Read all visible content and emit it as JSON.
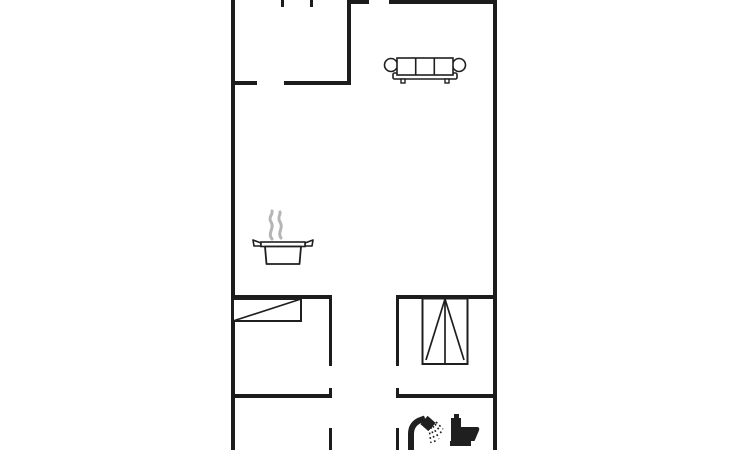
{
  "app": {
    "title": "floor-plan"
  },
  "canvas": {
    "width": 730,
    "height": 450,
    "background": "#ffffff"
  },
  "colors": {
    "wall": "#1c1c1c",
    "fixture": "#1f1f1f",
    "furniture_fill": "#ffffff",
    "steam": "#b5b5b5",
    "background": "#ffffff"
  },
  "walls": [
    {
      "name": "outer-wall-west",
      "x": 231,
      "y": 0,
      "w": 4,
      "h": 450
    },
    {
      "name": "outer-wall-east",
      "x": 493,
      "y": 0,
      "w": 4,
      "h": 450
    },
    {
      "name": "living-room-north-wall-west-segment",
      "x": 347,
      "y": 0,
      "w": 22,
      "h": 4
    },
    {
      "name": "living-room-north-wall-east-segment",
      "x": 389,
      "y": 0,
      "w": 108,
      "h": 4
    },
    {
      "name": "entrance-door-jamb-west",
      "x": 281,
      "y": 0,
      "w": 3,
      "h": 7
    },
    {
      "name": "entrance-door-jamb-east",
      "x": 310,
      "y": 0,
      "w": 3,
      "h": 7
    },
    {
      "name": "hall-living-divider-wall",
      "x": 347,
      "y": 0,
      "w": 4,
      "h": 85
    },
    {
      "name": "hall-south-wall-west-segment",
      "x": 231,
      "y": 81,
      "w": 26,
      "h": 4
    },
    {
      "name": "hall-south-wall-east-segment",
      "x": 284,
      "y": 81,
      "w": 67,
      "h": 4
    },
    {
      "name": "bedroom-north-wall-west",
      "x": 231,
      "y": 295,
      "w": 101,
      "h": 4
    },
    {
      "name": "bedroom-north-wall-east",
      "x": 396,
      "y": 295,
      "w": 101,
      "h": 4
    },
    {
      "name": "corridor-west-wall-upper",
      "x": 329,
      "y": 295,
      "w": 3,
      "h": 71
    },
    {
      "name": "corridor-east-wall-upper",
      "x": 396,
      "y": 295,
      "w": 3,
      "h": 71
    },
    {
      "name": "corridor-west-door-jamb",
      "x": 329,
      "y": 388,
      "w": 3,
      "h": 9
    },
    {
      "name": "corridor-east-door-jamb",
      "x": 396,
      "y": 388,
      "w": 3,
      "h": 9
    },
    {
      "name": "bedroom-south-wall-west",
      "x": 231,
      "y": 394,
      "w": 101,
      "h": 4
    },
    {
      "name": "bedroom-south-wall-east",
      "x": 396,
      "y": 394,
      "w": 101,
      "h": 4
    },
    {
      "name": "corridor-west-wall-lower",
      "x": 329,
      "y": 428,
      "w": 3,
      "h": 22
    },
    {
      "name": "corridor-east-wall-lower",
      "x": 396,
      "y": 428,
      "w": 3,
      "h": 22
    }
  ],
  "icons": [
    {
      "name": "sofa-icon",
      "kind": "three-seat-sofa",
      "x": 383,
      "y": 54,
      "w": 84,
      "h": 30
    },
    {
      "name": "cooking-pot-icon",
      "kind": "steaming-pot-hob",
      "x": 250,
      "y": 209,
      "w": 66,
      "h": 57
    },
    {
      "name": "bed-icon",
      "kind": "single-bed",
      "x": 232,
      "y": 297,
      "w": 71,
      "h": 25
    },
    {
      "name": "wardrobe-icon",
      "kind": "wardrobe-closet",
      "x": 421,
      "y": 297,
      "w": 48,
      "h": 69
    },
    {
      "name": "shower-icon",
      "kind": "shower-head-with-spray",
      "x": 406,
      "y": 414,
      "w": 38,
      "h": 36
    },
    {
      "name": "toilet-icon",
      "kind": "toilet-wc",
      "x": 448,
      "y": 412,
      "w": 34,
      "h": 36
    }
  ]
}
